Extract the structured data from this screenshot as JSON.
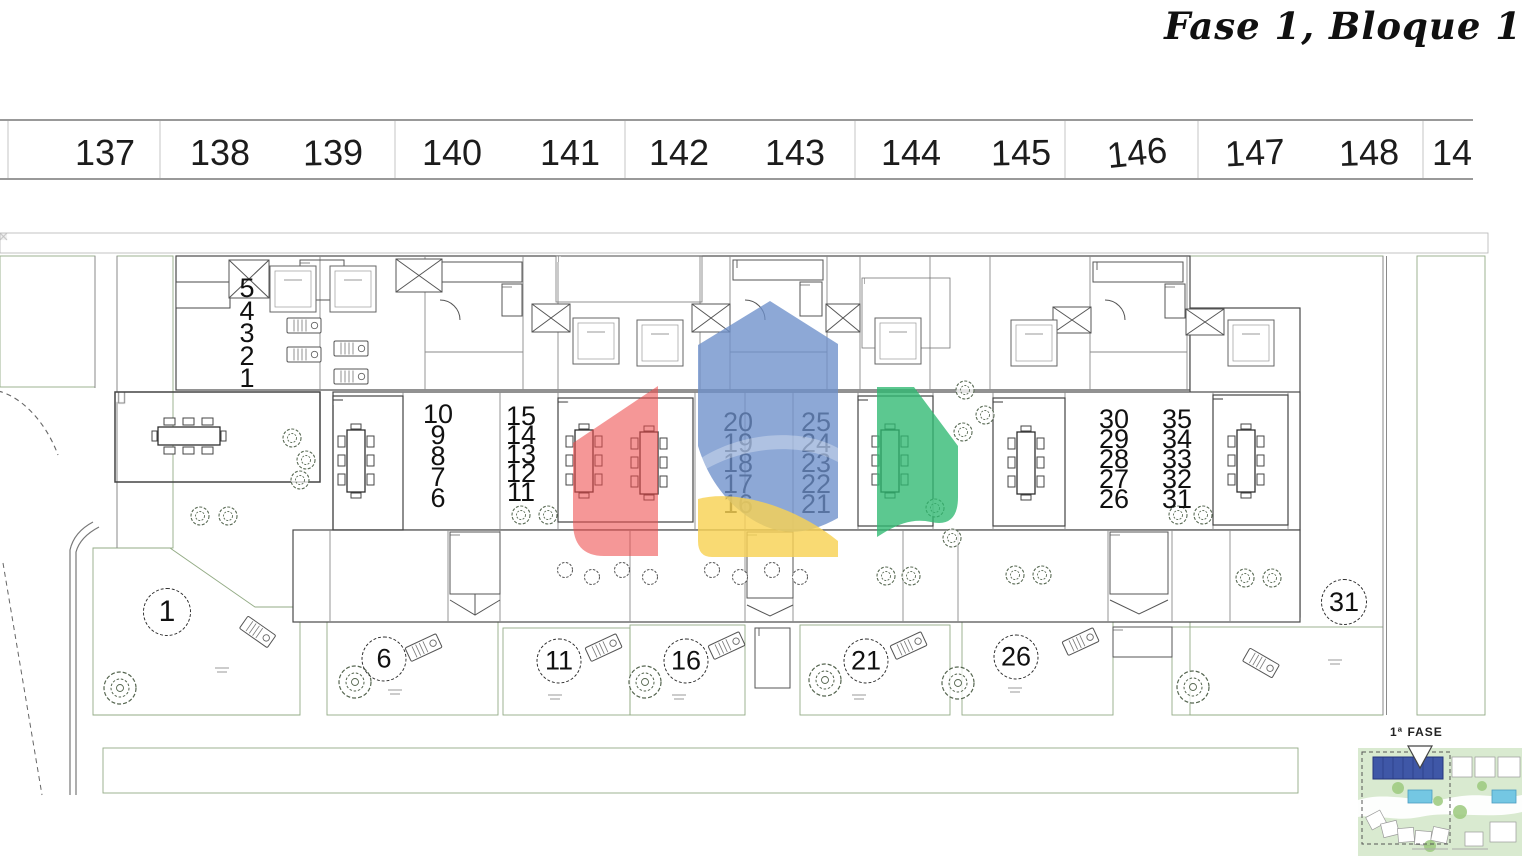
{
  "header": {
    "title": "Fase 1, Bloque 1"
  },
  "axis": {
    "labels": [
      "137",
      "138",
      "139",
      "140",
      "141",
      "142",
      "143",
      "144",
      "145",
      "146",
      "147",
      "148",
      "14"
    ]
  },
  "plan": {
    "unit_columns": [
      {
        "id": "units-1-5",
        "values": [
          "5",
          "4",
          "3",
          "2",
          "1"
        ]
      },
      {
        "id": "units-6-10",
        "values": [
          "10",
          "9",
          "8",
          "7",
          "6"
        ]
      },
      {
        "id": "units-11-15",
        "values": [
          "15",
          "14",
          "13",
          "12",
          "11"
        ]
      },
      {
        "id": "units-16-20",
        "values": [
          "20",
          "19",
          "18",
          "17",
          "16"
        ]
      },
      {
        "id": "units-21-25",
        "values": [
          "25",
          "24",
          "23",
          "22",
          "21"
        ]
      },
      {
        "id": "units-26-30",
        "values": [
          "30",
          "29",
          "28",
          "27",
          "26"
        ]
      },
      {
        "id": "units-31-35",
        "values": [
          "35",
          "34",
          "33",
          "32",
          "31"
        ]
      }
    ],
    "garden_markers": [
      "1",
      "6",
      "11",
      "16",
      "21",
      "26",
      "31"
    ]
  },
  "site_map": {
    "label": "1ª FASE"
  },
  "colors": {
    "garden_green": "#e3efda",
    "hatch_green": "#b6d3a4",
    "road_gray": "#c2c2c2",
    "line_dark": "#4a4a4a",
    "logo_red": "#ee4c4c",
    "logo_blue": "#6d8fcb",
    "logo_yellow": "#f8d254",
    "logo_green": "#2eb971",
    "minimap_phase_blue": "#3f57a7",
    "minimap_pool_blue": "#74c7e3"
  }
}
